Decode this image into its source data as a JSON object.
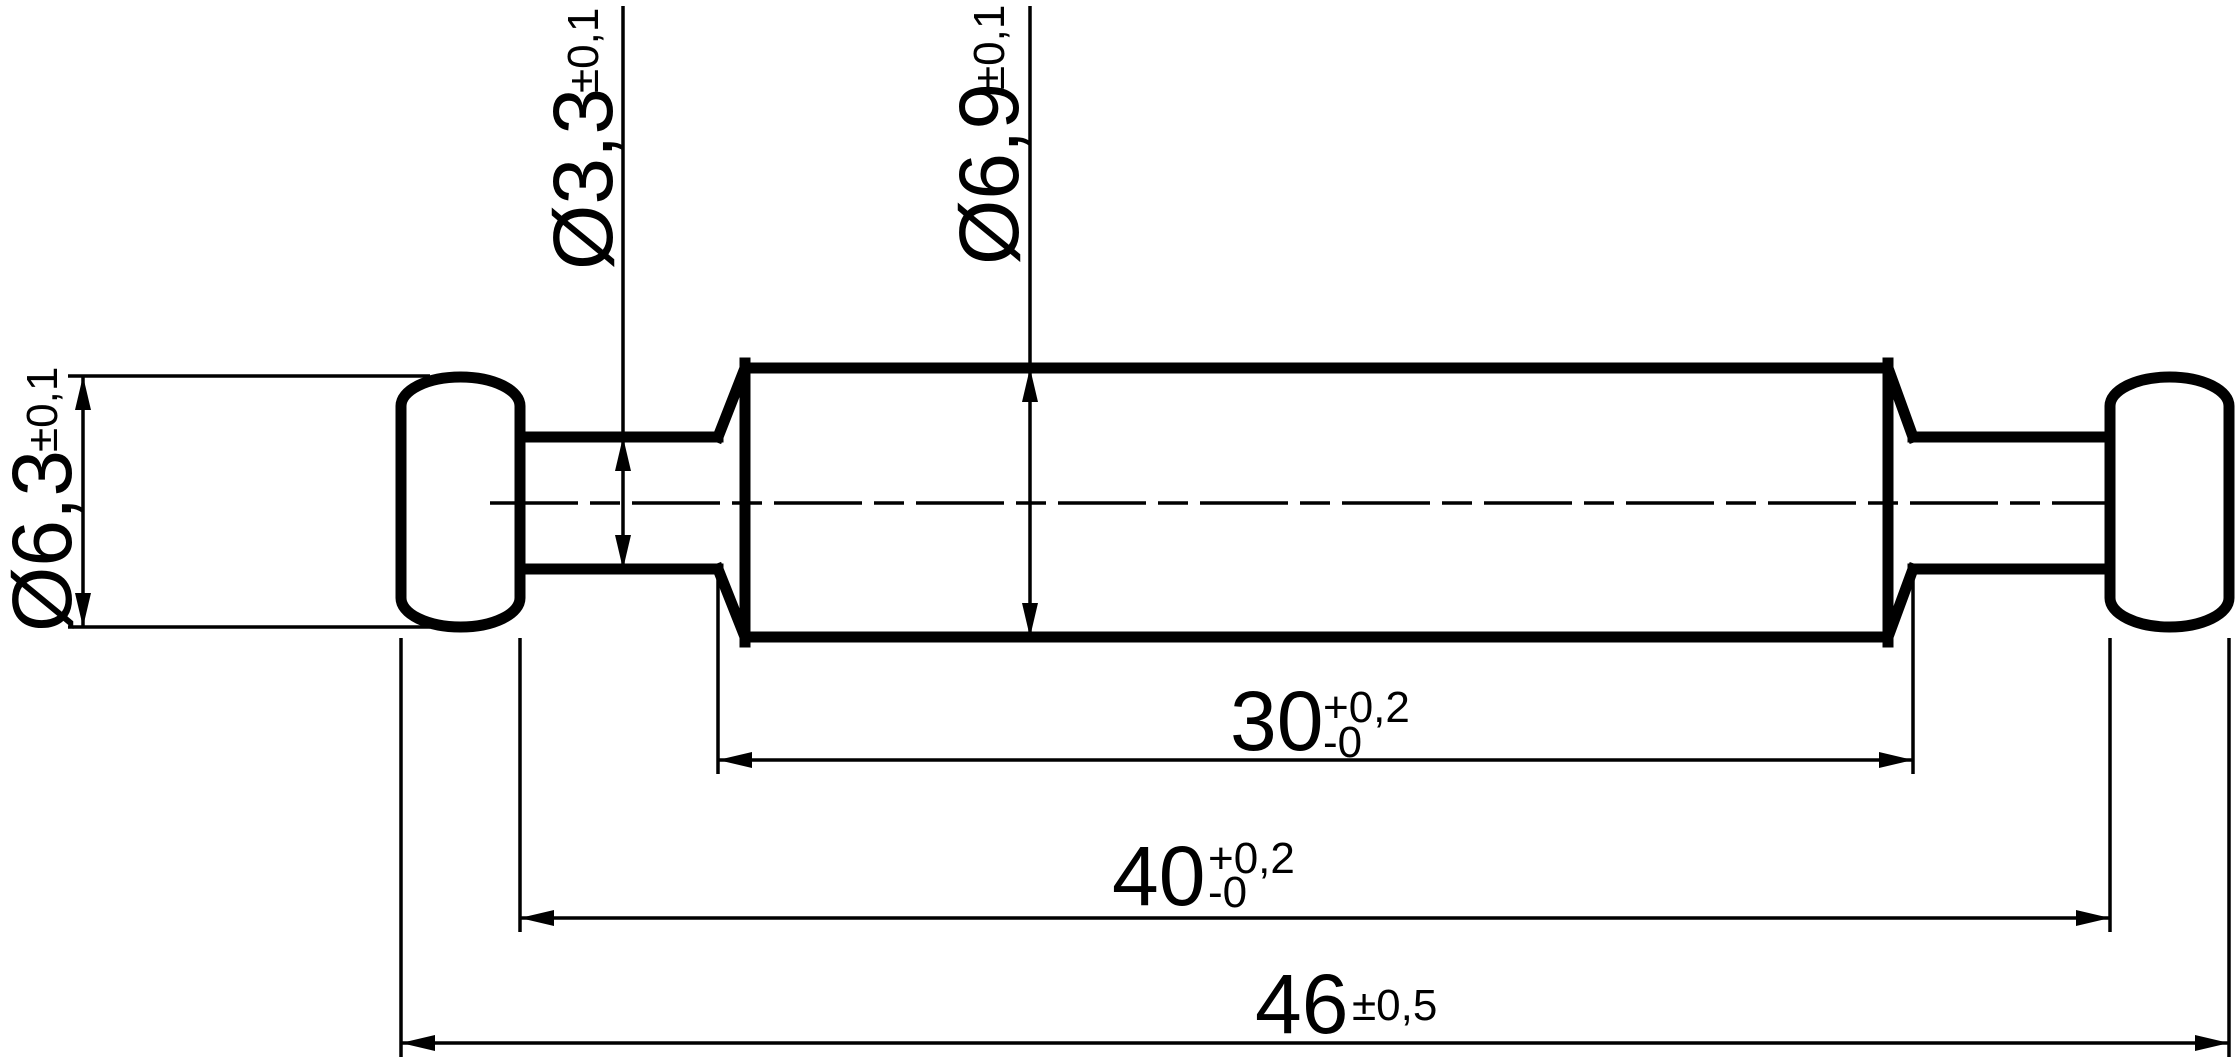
{
  "drawing": {
    "kind": "engineering-dimension-drawing",
    "part": "double-ended pin with rounded caps, two necks and central cylinder",
    "background_color": "#ffffff",
    "line_color": "#000000",
    "labels": {
      "neck_diameter": {
        "text": "Ø3,3",
        "tolerance": "±0,1"
      },
      "body_diameter": {
        "text": "Ø6,9",
        "tolerance": "±0,1"
      },
      "cap_diameter": {
        "text": "Ø6,3",
        "tolerance": "±0,1"
      },
      "body_length": {
        "text": "30",
        "tolerance_plus": "+0,2",
        "tolerance_minus": "-0"
      },
      "inner_length": {
        "text": "40",
        "tolerance_plus": "+0,2",
        "tolerance_minus": "-0"
      },
      "overall_length": {
        "text": "46",
        "tolerance": "±0,5"
      }
    }
  }
}
